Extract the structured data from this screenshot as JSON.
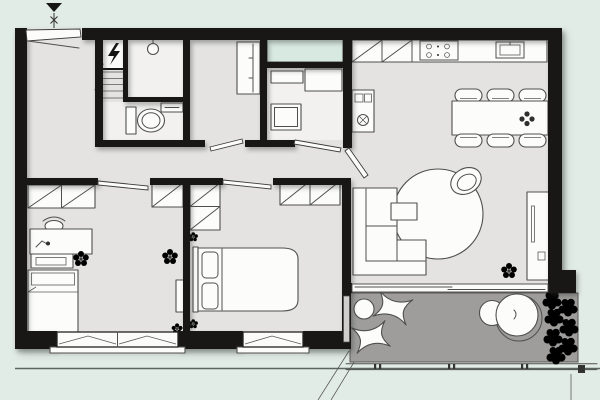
{
  "image": {
    "kind": "apartment-floor-plan",
    "view": "top-down architectural drawing",
    "width": 600,
    "height": 400,
    "visible_text": ""
  },
  "colors": {
    "background": "#e2ece6",
    "floor": "#e4e3e1",
    "floor_light": "#f2f1ef",
    "wall": "#181716",
    "line": "#4f4f4d",
    "glass": "#d8e9e1",
    "balcony_floor": "#9e9d9b",
    "furniture_white": "#fcfcfb",
    "dark_accent": "#2f2f2d"
  },
  "markers": {
    "entrance_arrow": "solid triangle pointing down above entry door",
    "section_line": "vertical line through entry with two x marks",
    "ground_line": "thin horizontal line across bottom of page",
    "projection_lines": "two short diagonals below bedroom/balcony corner",
    "plumb_line": "short vertical line below balcony right end"
  },
  "rooms": [
    {
      "id": "entry-hall",
      "fixtures": [
        "entrance-door",
        "door-swing-line",
        "electrical-panel-lightning-bolt",
        "slatted-shelf-unit"
      ]
    },
    {
      "id": "shower-room",
      "fixtures": [
        "ceiling-shower-head"
      ]
    },
    {
      "id": "wc",
      "fixtures": [
        "toilet",
        "wall-shelf"
      ]
    },
    {
      "id": "closet-room",
      "fixtures": [
        "tall-wardrobe",
        "door-leaf"
      ]
    },
    {
      "id": "study",
      "fixtures": [
        "glazed-window-bay",
        "wall-shelf",
        "corner-desk",
        "square-table",
        "door-leaf"
      ]
    },
    {
      "id": "hallway",
      "fixtures": [
        "door-leaf-kids-room",
        "door-leaf-bedroom",
        "door-leaf-living"
      ]
    },
    {
      "id": "kitchen-dining",
      "fixtures": [
        "upper-cabinets-diagonal",
        "counter",
        "cooktop-4-burners",
        "sink",
        "tall-oven-unit",
        "dining-table",
        "chair-x6",
        "table-plant"
      ]
    },
    {
      "id": "living-room",
      "fixtures": [
        "round-rug",
        "shell-armchair",
        "corner-sofa",
        "coffee-table",
        "tv-sideboard",
        "floor-plant",
        "sliding-glass-door"
      ]
    },
    {
      "id": "kids-room",
      "fixtures": [
        "closet-2-cells",
        "closet-1-cell",
        "desk",
        "desk-chair",
        "desk-lamp",
        "drawer-unit",
        "single-bed",
        "potted-plant",
        "potted-plant-2",
        "thin-shelf",
        "corner-flower",
        "casement-window-double"
      ]
    },
    {
      "id": "bedroom",
      "fixtures": [
        "closet-vertical-2-cells",
        "closet-2-cells",
        "double-bed",
        "pillow-x2",
        "wall-flower-x2",
        "casement-window-single",
        "balcony-door-panel"
      ]
    },
    {
      "id": "balcony",
      "fixtures": [
        "round-side-table",
        "butterfly-chair-x2",
        "round-lounge-chair-with-footrest",
        "shrub-column",
        "railing-with-ticks"
      ]
    }
  ]
}
